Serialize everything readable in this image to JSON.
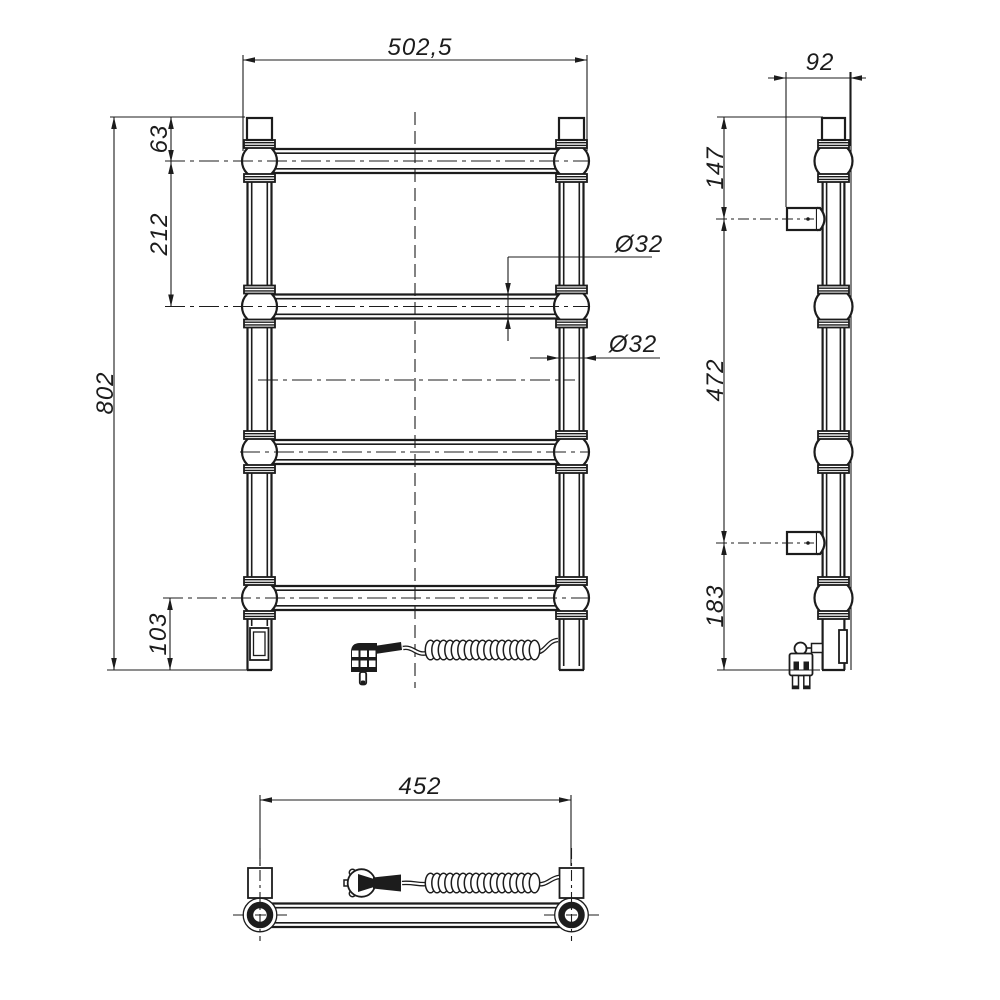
{
  "colors": {
    "line": "#1c1c1c",
    "background": "#ffffff"
  },
  "dimensions": {
    "front": {
      "overall_width": "502,5",
      "top_to_first_rail": "63",
      "first_to_second_rail": "212",
      "overall_height": "802",
      "last_rail_to_bottom": "103",
      "rail_diameter": "Ø32",
      "post_diameter": "Ø32"
    },
    "side": {
      "depth": "92",
      "top_to_upper_bracket": "147",
      "bracket_spacing": "472",
      "lower_bracket_to_bottom": "183"
    },
    "bottom": {
      "bracket_centers": "452"
    }
  }
}
